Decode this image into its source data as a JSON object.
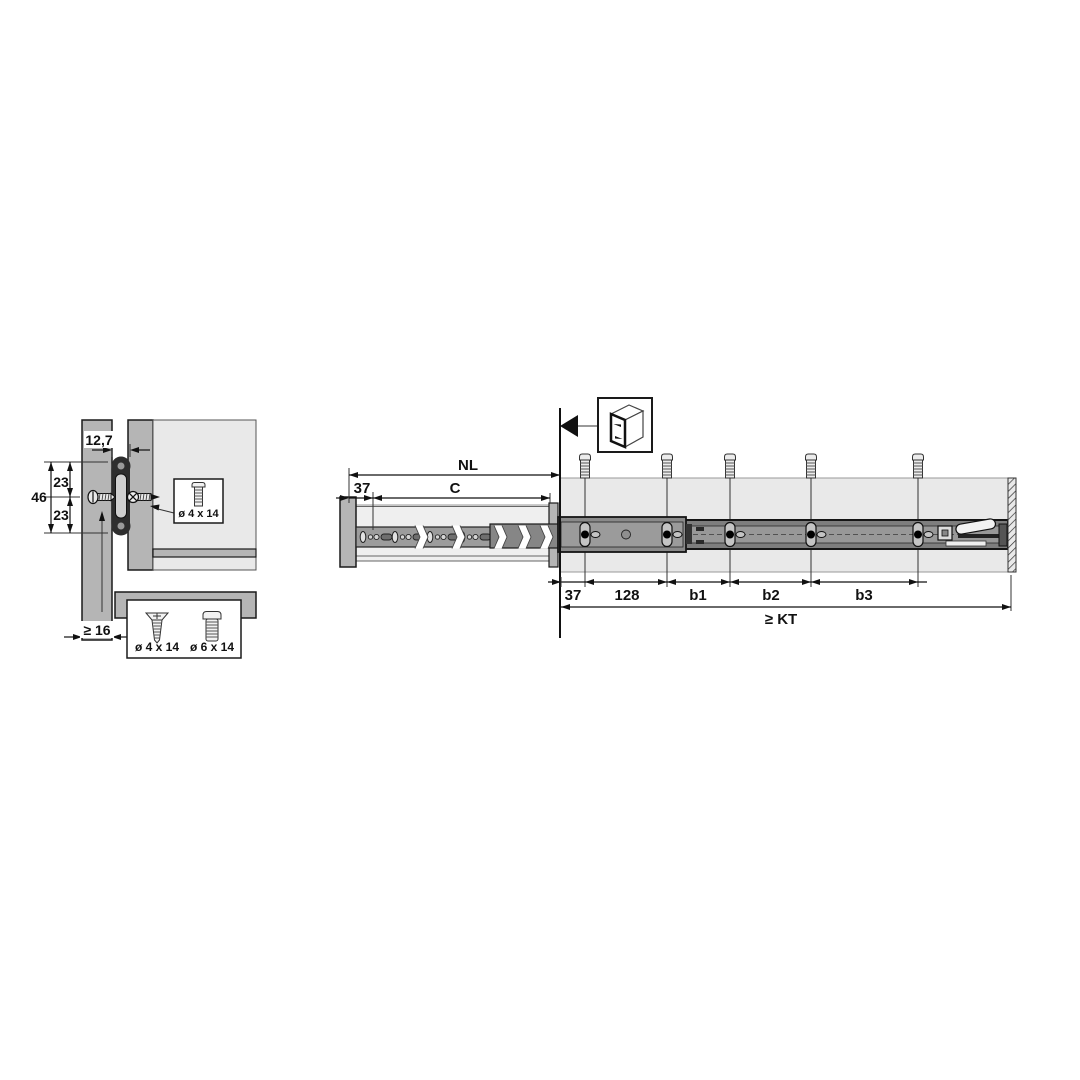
{
  "cross_section": {
    "dim_gap": "12,7",
    "dim_total": "46",
    "dim_upper": "23",
    "dim_lower": "23",
    "dim_min_panel": "≥ 16",
    "callout_screw": "ø 4 x 14",
    "legend_screw_small": "ø 4 x 14",
    "legend_screw_large": "ø 6 x 14"
  },
  "side_view": {
    "dim_nl": "NL",
    "dim_c": "C",
    "dim_front_offset": "37",
    "dim_first_hole": "37",
    "dim_pitch": "128",
    "dim_b1": "b1",
    "dim_b2": "b2",
    "dim_b3": "b3",
    "dim_kt": "≥ KT"
  },
  "icons": {
    "cabinet": "cabinet-icon",
    "front_arrow": "front-direction-arrow-icon",
    "screws": "mounting-screw-icon"
  },
  "colors": {
    "background": "#ffffff",
    "panel_gray": "#b5b5b5",
    "panel_light": "#e9e9e9",
    "rail_dark": "#7e7e7e",
    "rail_mid": "#9c9c9c",
    "line": "#111111"
  }
}
